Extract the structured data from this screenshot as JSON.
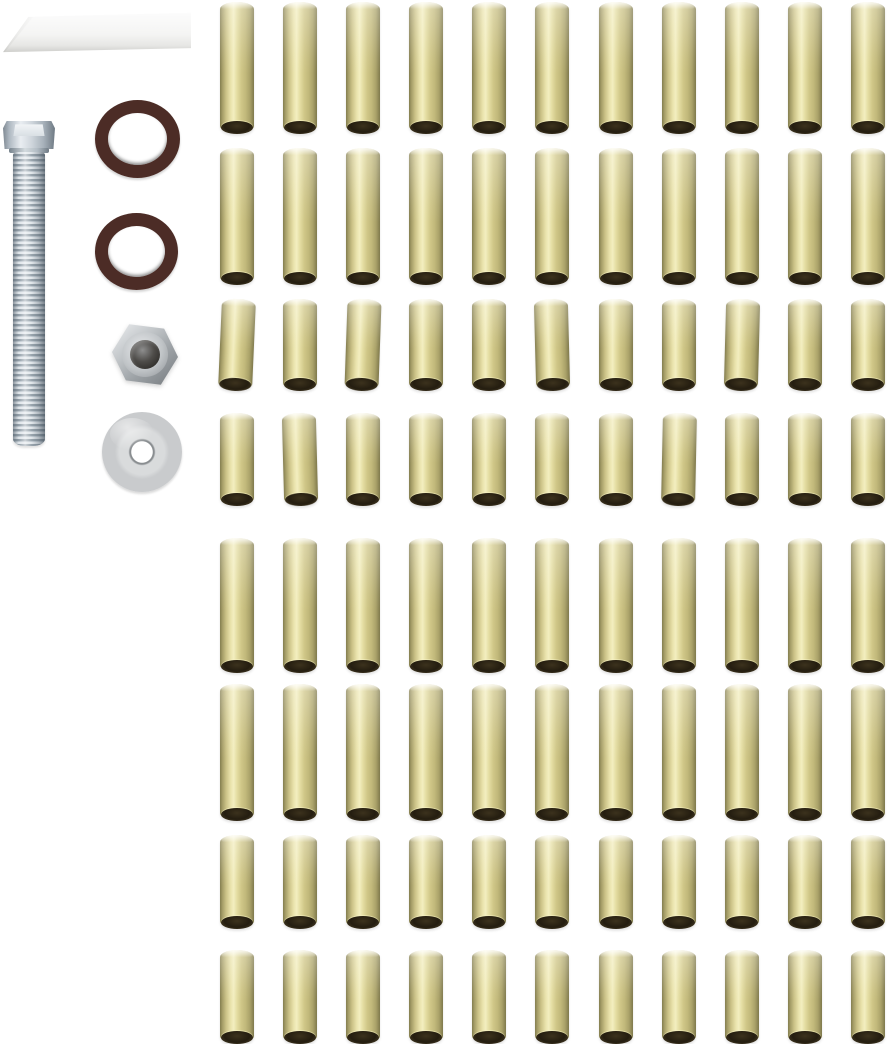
{
  "scene": {
    "type": "product-photo",
    "background_color": "#ffffff",
    "description": "Hardware kit photo: white plastic wedge, zinc hex-head bolt, two dark rubber o-rings, zinc hex nut, zinc flat washer, and a grid of brass spacer tubes"
  },
  "parts": {
    "wedge": {
      "label": "white plastic wedge",
      "color": "#f2f1ef",
      "count": 1
    },
    "bolt": {
      "label": "zinc hex head bolt",
      "head_color": "#c9d0d6",
      "thread_color": "#9aa5ae",
      "count": 1
    },
    "o_ring_top": {
      "label": "rubber o-ring",
      "color": "#4c2c26",
      "count": 1
    },
    "o_ring_bottom": {
      "label": "rubber o-ring",
      "color": "#4c2c26",
      "count": 1
    },
    "nut": {
      "label": "zinc hex nut",
      "color": "#b4b8bb",
      "count": 1
    },
    "washer": {
      "label": "zinc flat washer",
      "color": "#c9cbcd",
      "count": 1
    }
  },
  "spacer_grid": {
    "label": "brass spacer tubes",
    "tube_color": "#d8d094",
    "tube_highlight": "#f3eec0",
    "tube_edge": "#7f794c",
    "bore_color": "#241d10",
    "columns": 11,
    "total_count": 88,
    "rows": [
      {
        "name": "spacer-row-1",
        "length": "long",
        "count": 11,
        "top": 2,
        "height": 131
      },
      {
        "name": "spacer-row-2",
        "length": "long",
        "count": 11,
        "top": 148,
        "height": 136
      },
      {
        "name": "spacer-row-3",
        "length": "short",
        "count": 11,
        "top": 299,
        "height": 91
      },
      {
        "name": "spacer-row-4",
        "length": "short",
        "count": 11,
        "top": 413,
        "height": 92
      },
      {
        "name": "spacer-row-5",
        "length": "long",
        "count": 11,
        "top": 538,
        "height": 134
      },
      {
        "name": "spacer-row-6",
        "length": "long",
        "count": 11,
        "top": 684,
        "height": 136
      },
      {
        "name": "spacer-row-7",
        "length": "short",
        "count": 11,
        "top": 835,
        "height": 93
      },
      {
        "name": "spacer-row-8",
        "length": "short",
        "count": 11,
        "top": 950,
        "height": 93
      }
    ]
  }
}
